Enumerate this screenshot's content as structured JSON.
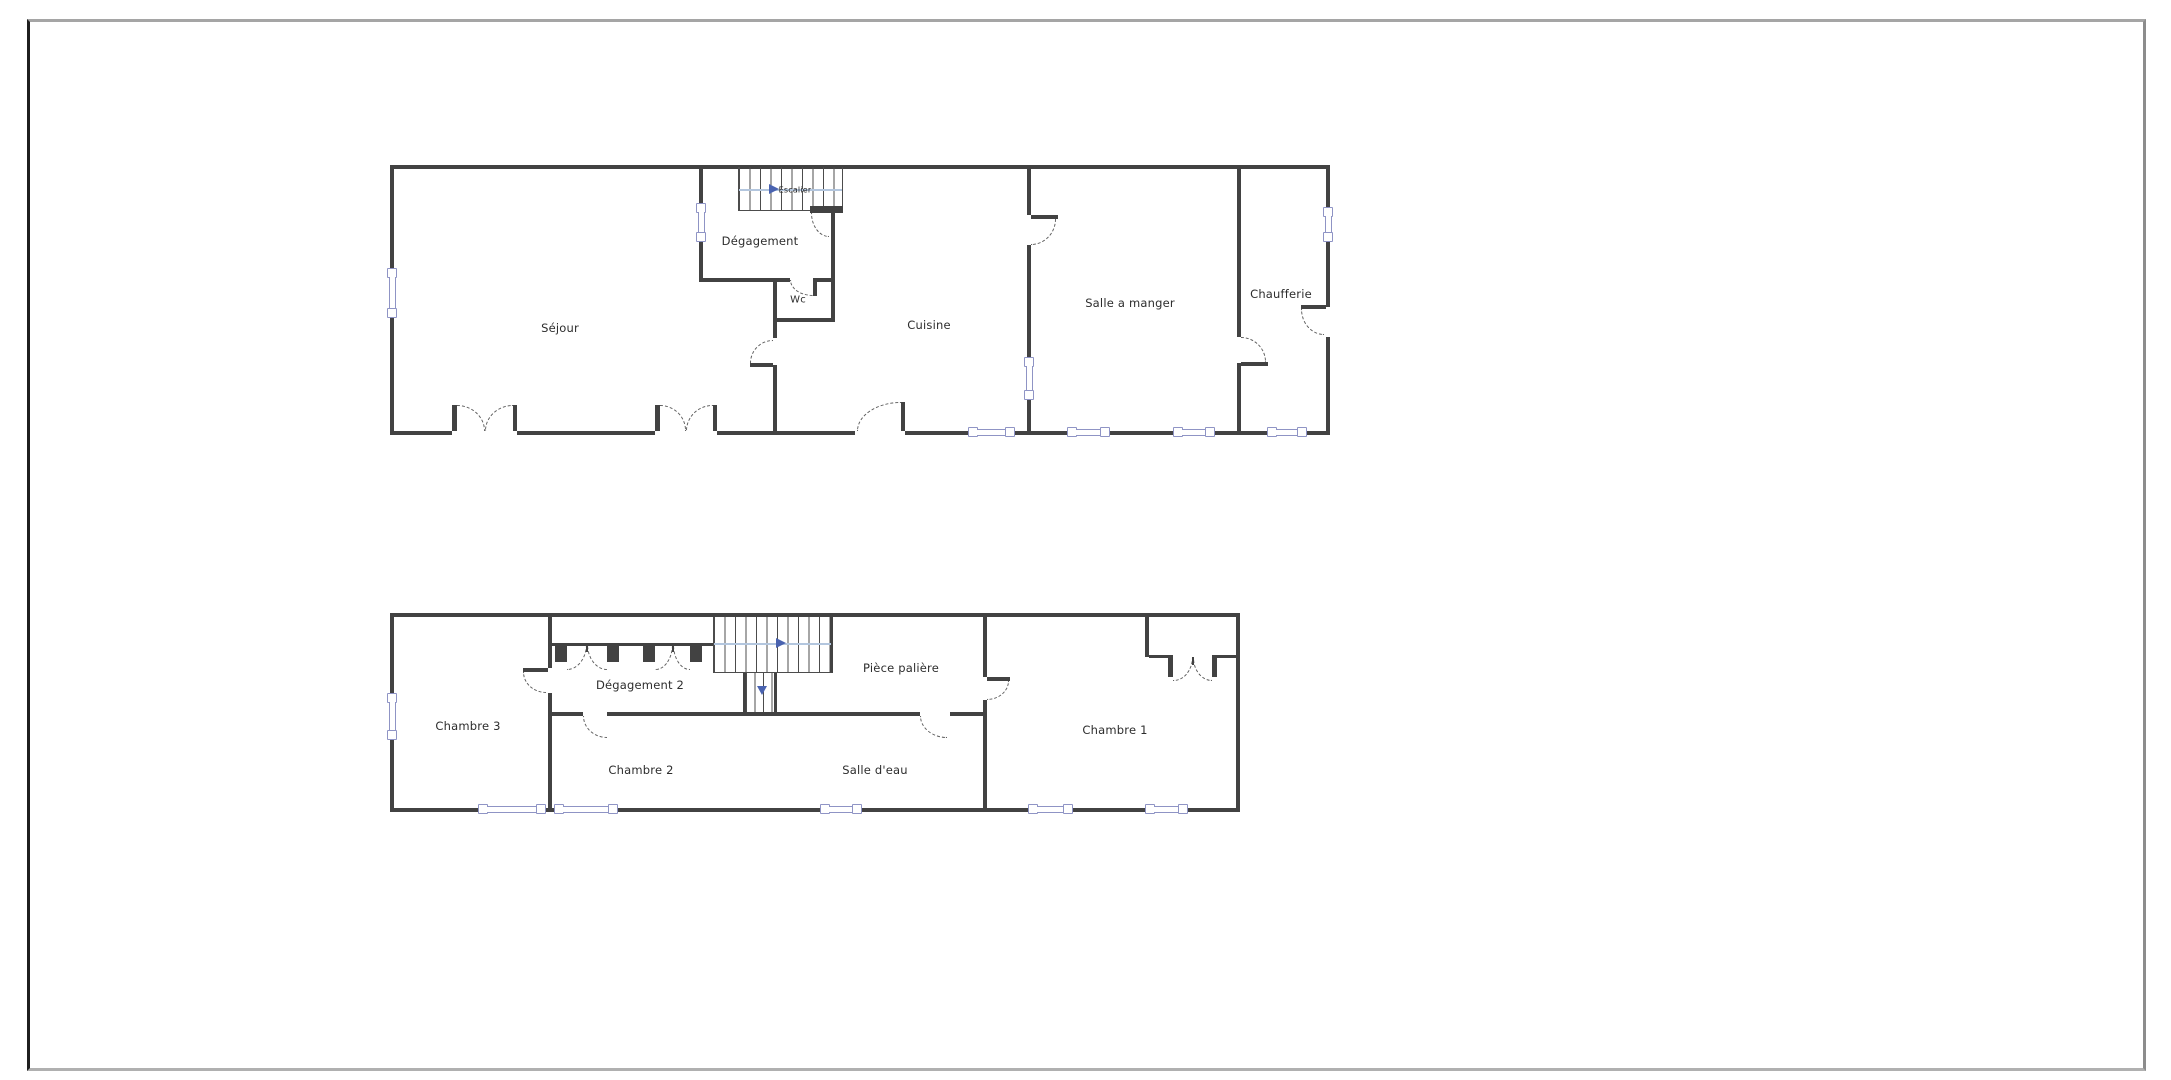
{
  "colors": {
    "wall": "#424242",
    "win": "#8f94c5",
    "door": "#5f5f5f",
    "arrow": "#4a63b0",
    "guide": "#b3c6de",
    "text": "#2d2d2d",
    "border_dark": "#1f1f1f",
    "border_gray": "#a5a5a5",
    "border_right": "#8c8c8c",
    "border_bottom": "#b0b0b0"
  },
  "plans": {
    "ground": {
      "rooms": {
        "sejour": "Séjour",
        "degagement": "Dégagement",
        "wc": "Wc",
        "cuisine": "Cuisine",
        "salle_a_manger": "Salle a manger",
        "chaufferie": "Chaufferie",
        "escalier": "Escalier"
      }
    },
    "first": {
      "rooms": {
        "chambre3": "Chambre 3",
        "degagement2": "Dégagement 2",
        "chambre2": "Chambre 2",
        "piece_paliere": "Pièce palière",
        "salle_deau": "Salle d'eau",
        "chambre1": "Chambre 1"
      }
    }
  }
}
